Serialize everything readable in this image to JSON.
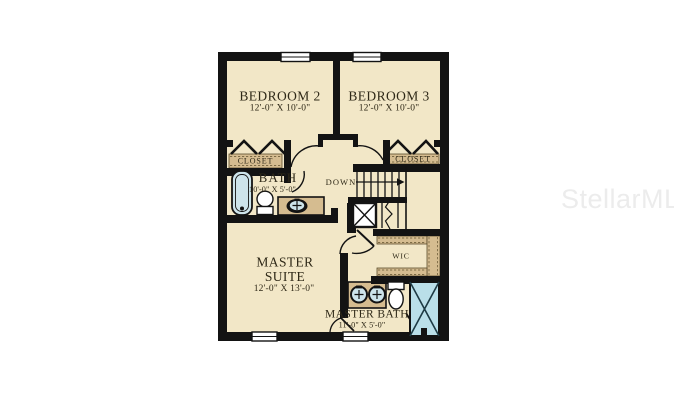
{
  "watermark": {
    "text": "StellarMLS"
  },
  "plan": {
    "rooms": {
      "bedroom2": {
        "name": "BEDROOM 2",
        "dims": "12'-0\" X 10'-0\""
      },
      "bedroom3": {
        "name": "BEDROOM 3",
        "dims": "12'-0\" X 10'-0\""
      },
      "bath": {
        "name": "BATH",
        "dims": "10'-0\" X 5'-0\""
      },
      "master_suite": {
        "name_line1": "MASTER",
        "name_line2": "SUITE",
        "dims": "12'-0\" X 13'-0\""
      },
      "master_bath": {
        "name": "MASTER BATH",
        "dims": "11'-0\" X 5'-0\""
      },
      "wic": {
        "name": "WIC"
      },
      "closet_left": {
        "name": "CLOSET"
      },
      "closet_right": {
        "name": "CLOSET"
      }
    },
    "stairs": {
      "label": "DOWN"
    },
    "colors": {
      "wall": "#131313",
      "floor": "#f2e7c7",
      "casework": "#d5bc90",
      "fixture_blue": "#cde4eb",
      "shower_blue": "#badfe9",
      "label_text": "#2e2817",
      "watermark": "#ececec"
    }
  }
}
